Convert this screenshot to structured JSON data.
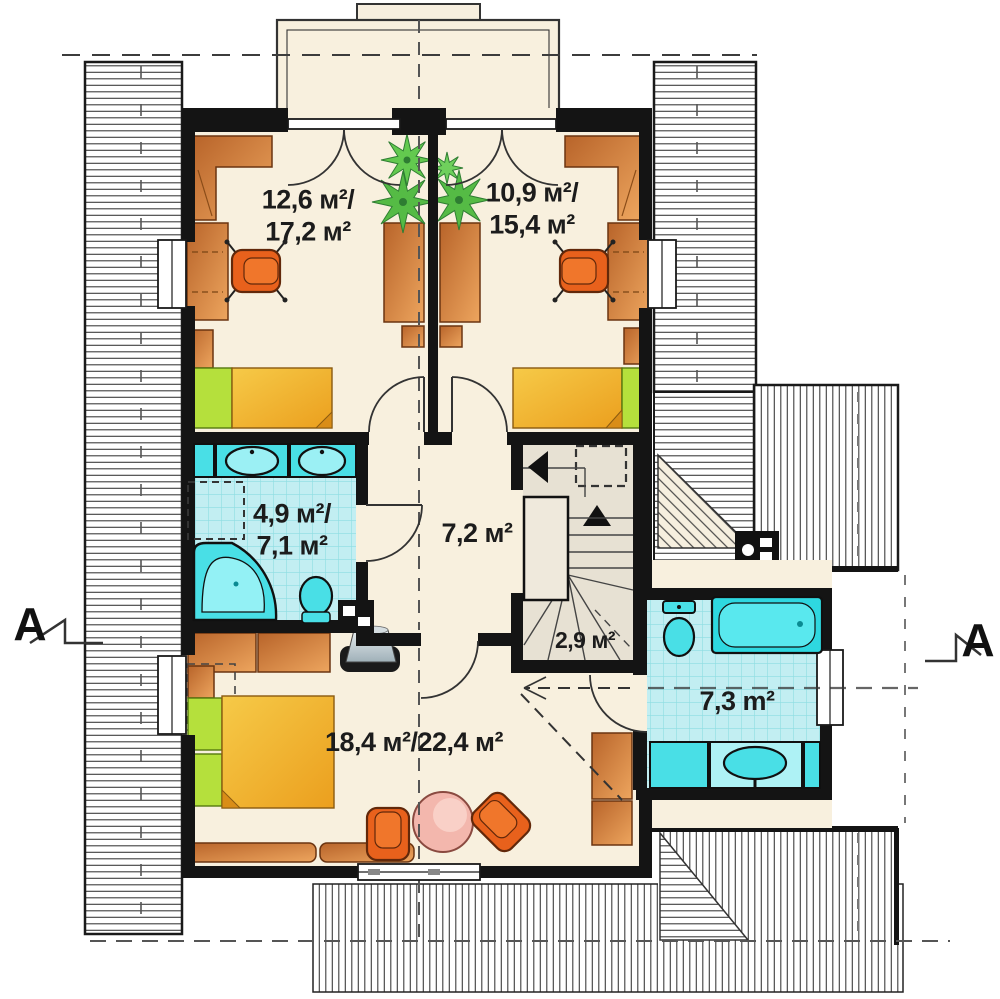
{
  "labels": {
    "bedroom_top_left": {
      "line1": "12,6 м²/",
      "line2": "17,2 м²"
    },
    "bedroom_top_right": {
      "line1": "10,9 м²/",
      "line2": "15,4 м²"
    },
    "bathroom_left": {
      "line1": "4,9 м²/",
      "line2": "7,1 м²"
    },
    "hallway": {
      "line1": "7,2 м²"
    },
    "staircase": {
      "line1": "2,9 м²"
    },
    "bathroom_right": {
      "line1": "7,3 m²"
    },
    "bedroom_bottom": {
      "line1": "18,4 м²/22,4 м²"
    }
  },
  "section_markers": {
    "left": "A",
    "right": "A"
  },
  "colors": {
    "wall": "#141414",
    "floor": "#f8f0de",
    "stair_floor": "#e7e1d3",
    "fixture": "#49dfe6",
    "tile": "#c2eef2",
    "pillow_green": "#b5e03c",
    "chair_orange": "#e8611c",
    "furniture_brown": "#c97f3f",
    "bed_yellow": "#f2b82e",
    "plant_green": "#55bb45",
    "table_pink": "#f3b7ad"
  }
}
